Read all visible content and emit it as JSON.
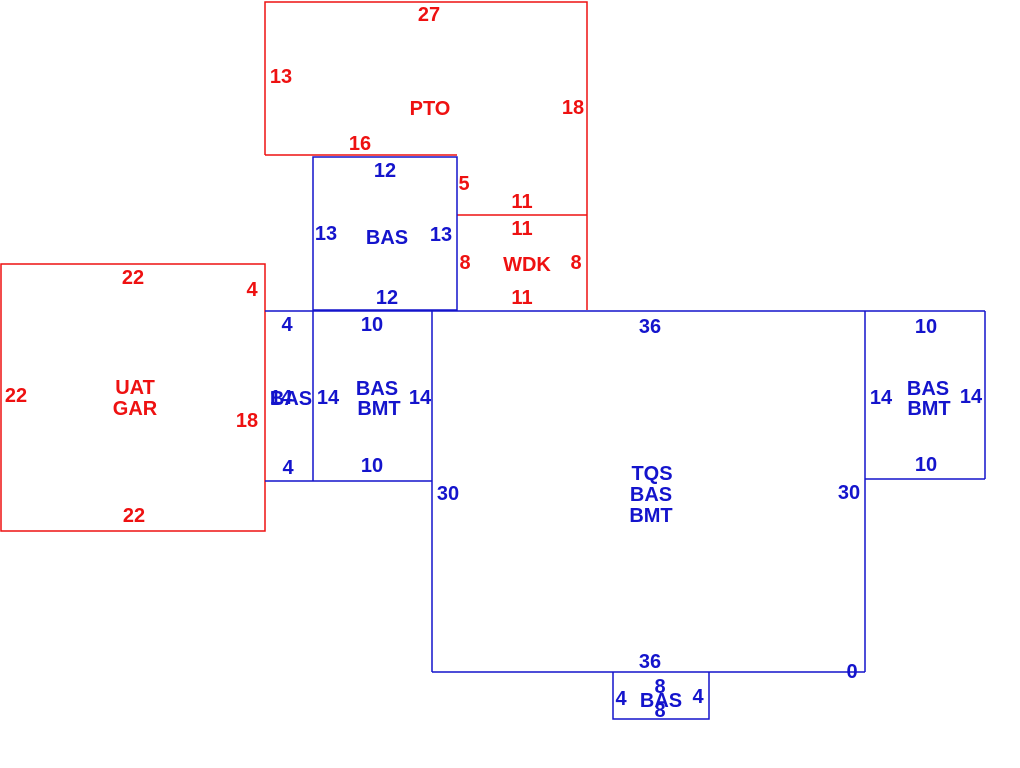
{
  "canvas": {
    "width": 1020,
    "height": 768,
    "background": "#ffffff"
  },
  "palette": {
    "red": "#ee1111",
    "blue": "#1414cc"
  },
  "sketch": {
    "shapes": [
      {
        "name": "pto-outline",
        "color": "red",
        "closed": false,
        "points": [
          [
            265,
            155
          ],
          [
            265,
            2
          ],
          [
            587,
            2
          ],
          [
            587,
            310
          ]
        ]
      },
      {
        "name": "pto-bottom-edge",
        "color": "red",
        "closed": false,
        "points": [
          [
            265,
            155
          ],
          [
            457,
            155
          ]
        ]
      },
      {
        "name": "wdk-top-edge",
        "color": "red",
        "closed": false,
        "points": [
          [
            457,
            215
          ],
          [
            587,
            215
          ]
        ]
      },
      {
        "name": "uat-gar-outline",
        "color": "red",
        "closed": true,
        "points": [
          [
            1,
            264
          ],
          [
            265,
            264
          ],
          [
            265,
            531
          ],
          [
            1,
            531
          ]
        ]
      },
      {
        "name": "bas-upper-outline",
        "color": "blue",
        "closed": true,
        "points": [
          [
            313,
            157
          ],
          [
            457,
            157
          ],
          [
            457,
            310
          ],
          [
            313,
            310
          ]
        ]
      },
      {
        "name": "main-top-edge",
        "color": "blue",
        "closed": false,
        "points": [
          [
            265,
            311
          ],
          [
            985,
            311
          ]
        ]
      },
      {
        "name": "strip-divider",
        "color": "blue",
        "closed": false,
        "points": [
          [
            313,
            311
          ],
          [
            313,
            481
          ]
        ]
      },
      {
        "name": "strip-bottom-edge",
        "color": "blue",
        "closed": false,
        "points": [
          [
            265,
            481
          ],
          [
            432,
            481
          ]
        ]
      },
      {
        "name": "tqs-left-edge",
        "color": "blue",
        "closed": false,
        "points": [
          [
            432,
            311
          ],
          [
            432,
            672
          ]
        ]
      },
      {
        "name": "tqs-bottom-edge",
        "color": "blue",
        "closed": false,
        "points": [
          [
            432,
            672
          ],
          [
            865,
            672
          ]
        ]
      },
      {
        "name": "tqs-right-edge",
        "color": "blue",
        "closed": false,
        "points": [
          [
            865,
            311
          ],
          [
            865,
            672
          ]
        ]
      },
      {
        "name": "right-bmt-right-edge",
        "color": "blue",
        "closed": false,
        "points": [
          [
            985,
            311
          ],
          [
            985,
            479
          ]
        ]
      },
      {
        "name": "right-bmt-bottom-edge",
        "color": "blue",
        "closed": false,
        "points": [
          [
            865,
            479
          ],
          [
            985,
            479
          ]
        ]
      },
      {
        "name": "bottom-bas-outline",
        "color": "blue",
        "closed": false,
        "points": [
          [
            613,
            672
          ],
          [
            613,
            719
          ],
          [
            709,
            719
          ],
          [
            709,
            672
          ]
        ]
      }
    ],
    "labels": [
      {
        "name": "pto-dim-top",
        "text": "27",
        "color": "red",
        "x": 429,
        "y": 14
      },
      {
        "name": "pto-dim-left",
        "text": "13",
        "color": "red",
        "x": 281,
        "y": 76
      },
      {
        "name": "pto-code",
        "text": "PTO",
        "color": "red",
        "x": 430,
        "y": 108
      },
      {
        "name": "pto-dim-right",
        "text": "18",
        "color": "red",
        "x": 573,
        "y": 107
      },
      {
        "name": "pto-dim-bottom",
        "text": "16",
        "color": "red",
        "x": 360,
        "y": 143
      },
      {
        "name": "pto-dim-step",
        "text": "5",
        "color": "red",
        "x": 464,
        "y": 183
      },
      {
        "name": "pto-dim-bottom-right",
        "text": "11",
        "color": "red",
        "x": 522,
        "y": 201
      },
      {
        "name": "wdk-dim-top",
        "text": "11",
        "color": "red",
        "x": 522,
        "y": 228
      },
      {
        "name": "wdk-dim-left",
        "text": "8",
        "color": "red",
        "x": 465,
        "y": 262
      },
      {
        "name": "wdk-code",
        "text": "WDK",
        "color": "red",
        "x": 527,
        "y": 264
      },
      {
        "name": "wdk-dim-right",
        "text": "8",
        "color": "red",
        "x": 576,
        "y": 262
      },
      {
        "name": "wdk-dim-bottom",
        "text": "11",
        "color": "red",
        "x": 522,
        "y": 297
      },
      {
        "name": "uat-gar-dim-top",
        "text": "22",
        "color": "red",
        "x": 133,
        "y": 277
      },
      {
        "name": "uat-gar-dim-right-upper",
        "text": "4",
        "color": "red",
        "x": 252,
        "y": 289
      },
      {
        "name": "uat-gar-dim-left",
        "text": "22",
        "color": "red",
        "x": 16,
        "y": 395
      },
      {
        "name": "uat-gar-code-line1",
        "text": "UAT",
        "color": "red",
        "x": 135,
        "y": 387
      },
      {
        "name": "uat-gar-code-line2",
        "text": "GAR",
        "color": "red",
        "x": 135,
        "y": 408
      },
      {
        "name": "uat-gar-dim-right-lower",
        "text": "18",
        "color": "red",
        "x": 247,
        "y": 420
      },
      {
        "name": "uat-gar-dim-bottom",
        "text": "22",
        "color": "red",
        "x": 134,
        "y": 515
      },
      {
        "name": "bas-upper-dim-top",
        "text": "12",
        "color": "blue",
        "x": 385,
        "y": 170
      },
      {
        "name": "bas-upper-dim-left",
        "text": "13",
        "color": "blue",
        "x": 326,
        "y": 233
      },
      {
        "name": "bas-upper-code",
        "text": "BAS",
        "color": "blue",
        "x": 387,
        "y": 237
      },
      {
        "name": "bas-upper-dim-right",
        "text": "13",
        "color": "blue",
        "x": 441,
        "y": 234
      },
      {
        "name": "bas-upper-dim-bottom",
        "text": "12",
        "color": "blue",
        "x": 387,
        "y": 297
      },
      {
        "name": "strip-dim-top",
        "text": "4",
        "color": "blue",
        "x": 287,
        "y": 324
      },
      {
        "name": "left-bmt-dim-top",
        "text": "10",
        "color": "blue",
        "x": 372,
        "y": 324
      },
      {
        "name": "tqs-dim-top",
        "text": "36",
        "color": "blue",
        "x": 650,
        "y": 326
      },
      {
        "name": "right-bmt-dim-top",
        "text": "10",
        "color": "blue",
        "x": 926,
        "y": 326
      },
      {
        "name": "strip-dim-side",
        "text": "14",
        "color": "blue",
        "x": 281,
        "y": 397
      },
      {
        "name": "strip-code",
        "text": "BAS",
        "color": "blue",
        "x": 291,
        "y": 398
      },
      {
        "name": "left-bmt-dim-left",
        "text": "14",
        "color": "blue",
        "x": 328,
        "y": 397
      },
      {
        "name": "left-bmt-code-line1",
        "text": "BAS",
        "color": "blue",
        "x": 377,
        "y": 388
      },
      {
        "name": "left-bmt-code-line2",
        "text": "BMT",
        "color": "blue",
        "x": 379,
        "y": 408
      },
      {
        "name": "left-bmt-dim-right",
        "text": "14",
        "color": "blue",
        "x": 420,
        "y": 397
      },
      {
        "name": "right-bmt-dim-left",
        "text": "14",
        "color": "blue",
        "x": 881,
        "y": 397
      },
      {
        "name": "right-bmt-code-line1",
        "text": "BAS",
        "color": "blue",
        "x": 928,
        "y": 388
      },
      {
        "name": "right-bmt-code-line2",
        "text": "BMT",
        "color": "blue",
        "x": 929,
        "y": 408
      },
      {
        "name": "right-bmt-dim-right",
        "text": "14",
        "color": "blue",
        "x": 971,
        "y": 396
      },
      {
        "name": "strip-dim-bottom",
        "text": "4",
        "color": "blue",
        "x": 288,
        "y": 467
      },
      {
        "name": "left-bmt-dim-bottom",
        "text": "10",
        "color": "blue",
        "x": 372,
        "y": 465
      },
      {
        "name": "right-bmt-dim-bottom",
        "text": "10",
        "color": "blue",
        "x": 926,
        "y": 464
      },
      {
        "name": "tqs-dim-left",
        "text": "30",
        "color": "blue",
        "x": 448,
        "y": 493
      },
      {
        "name": "tqs-dim-right",
        "text": "30",
        "color": "blue",
        "x": 849,
        "y": 492
      },
      {
        "name": "tqs-code-line1",
        "text": "TQS",
        "color": "blue",
        "x": 652,
        "y": 473
      },
      {
        "name": "tqs-code-line2",
        "text": "BAS",
        "color": "blue",
        "x": 651,
        "y": 494
      },
      {
        "name": "tqs-code-line3",
        "text": "BMT",
        "color": "blue",
        "x": 651,
        "y": 515
      },
      {
        "name": "tqs-dim-bottom",
        "text": "36",
        "color": "blue",
        "x": 650,
        "y": 661
      },
      {
        "name": "tqs-dim-corner",
        "text": "0",
        "color": "blue",
        "x": 852,
        "y": 671
      },
      {
        "name": "bottom-bas-dim-top",
        "text": "8",
        "color": "blue",
        "x": 660,
        "y": 686
      },
      {
        "name": "bottom-bas-dim-left",
        "text": "4",
        "color": "blue",
        "x": 621,
        "y": 698
      },
      {
        "name": "bottom-bas-code",
        "text": "BAS",
        "color": "blue",
        "x": 661,
        "y": 700
      },
      {
        "name": "bottom-bas-dim-right",
        "text": "4",
        "color": "blue",
        "x": 698,
        "y": 696
      },
      {
        "name": "bottom-bas-dim-bottom",
        "text": "8",
        "color": "blue",
        "x": 660,
        "y": 710
      }
    ]
  }
}
